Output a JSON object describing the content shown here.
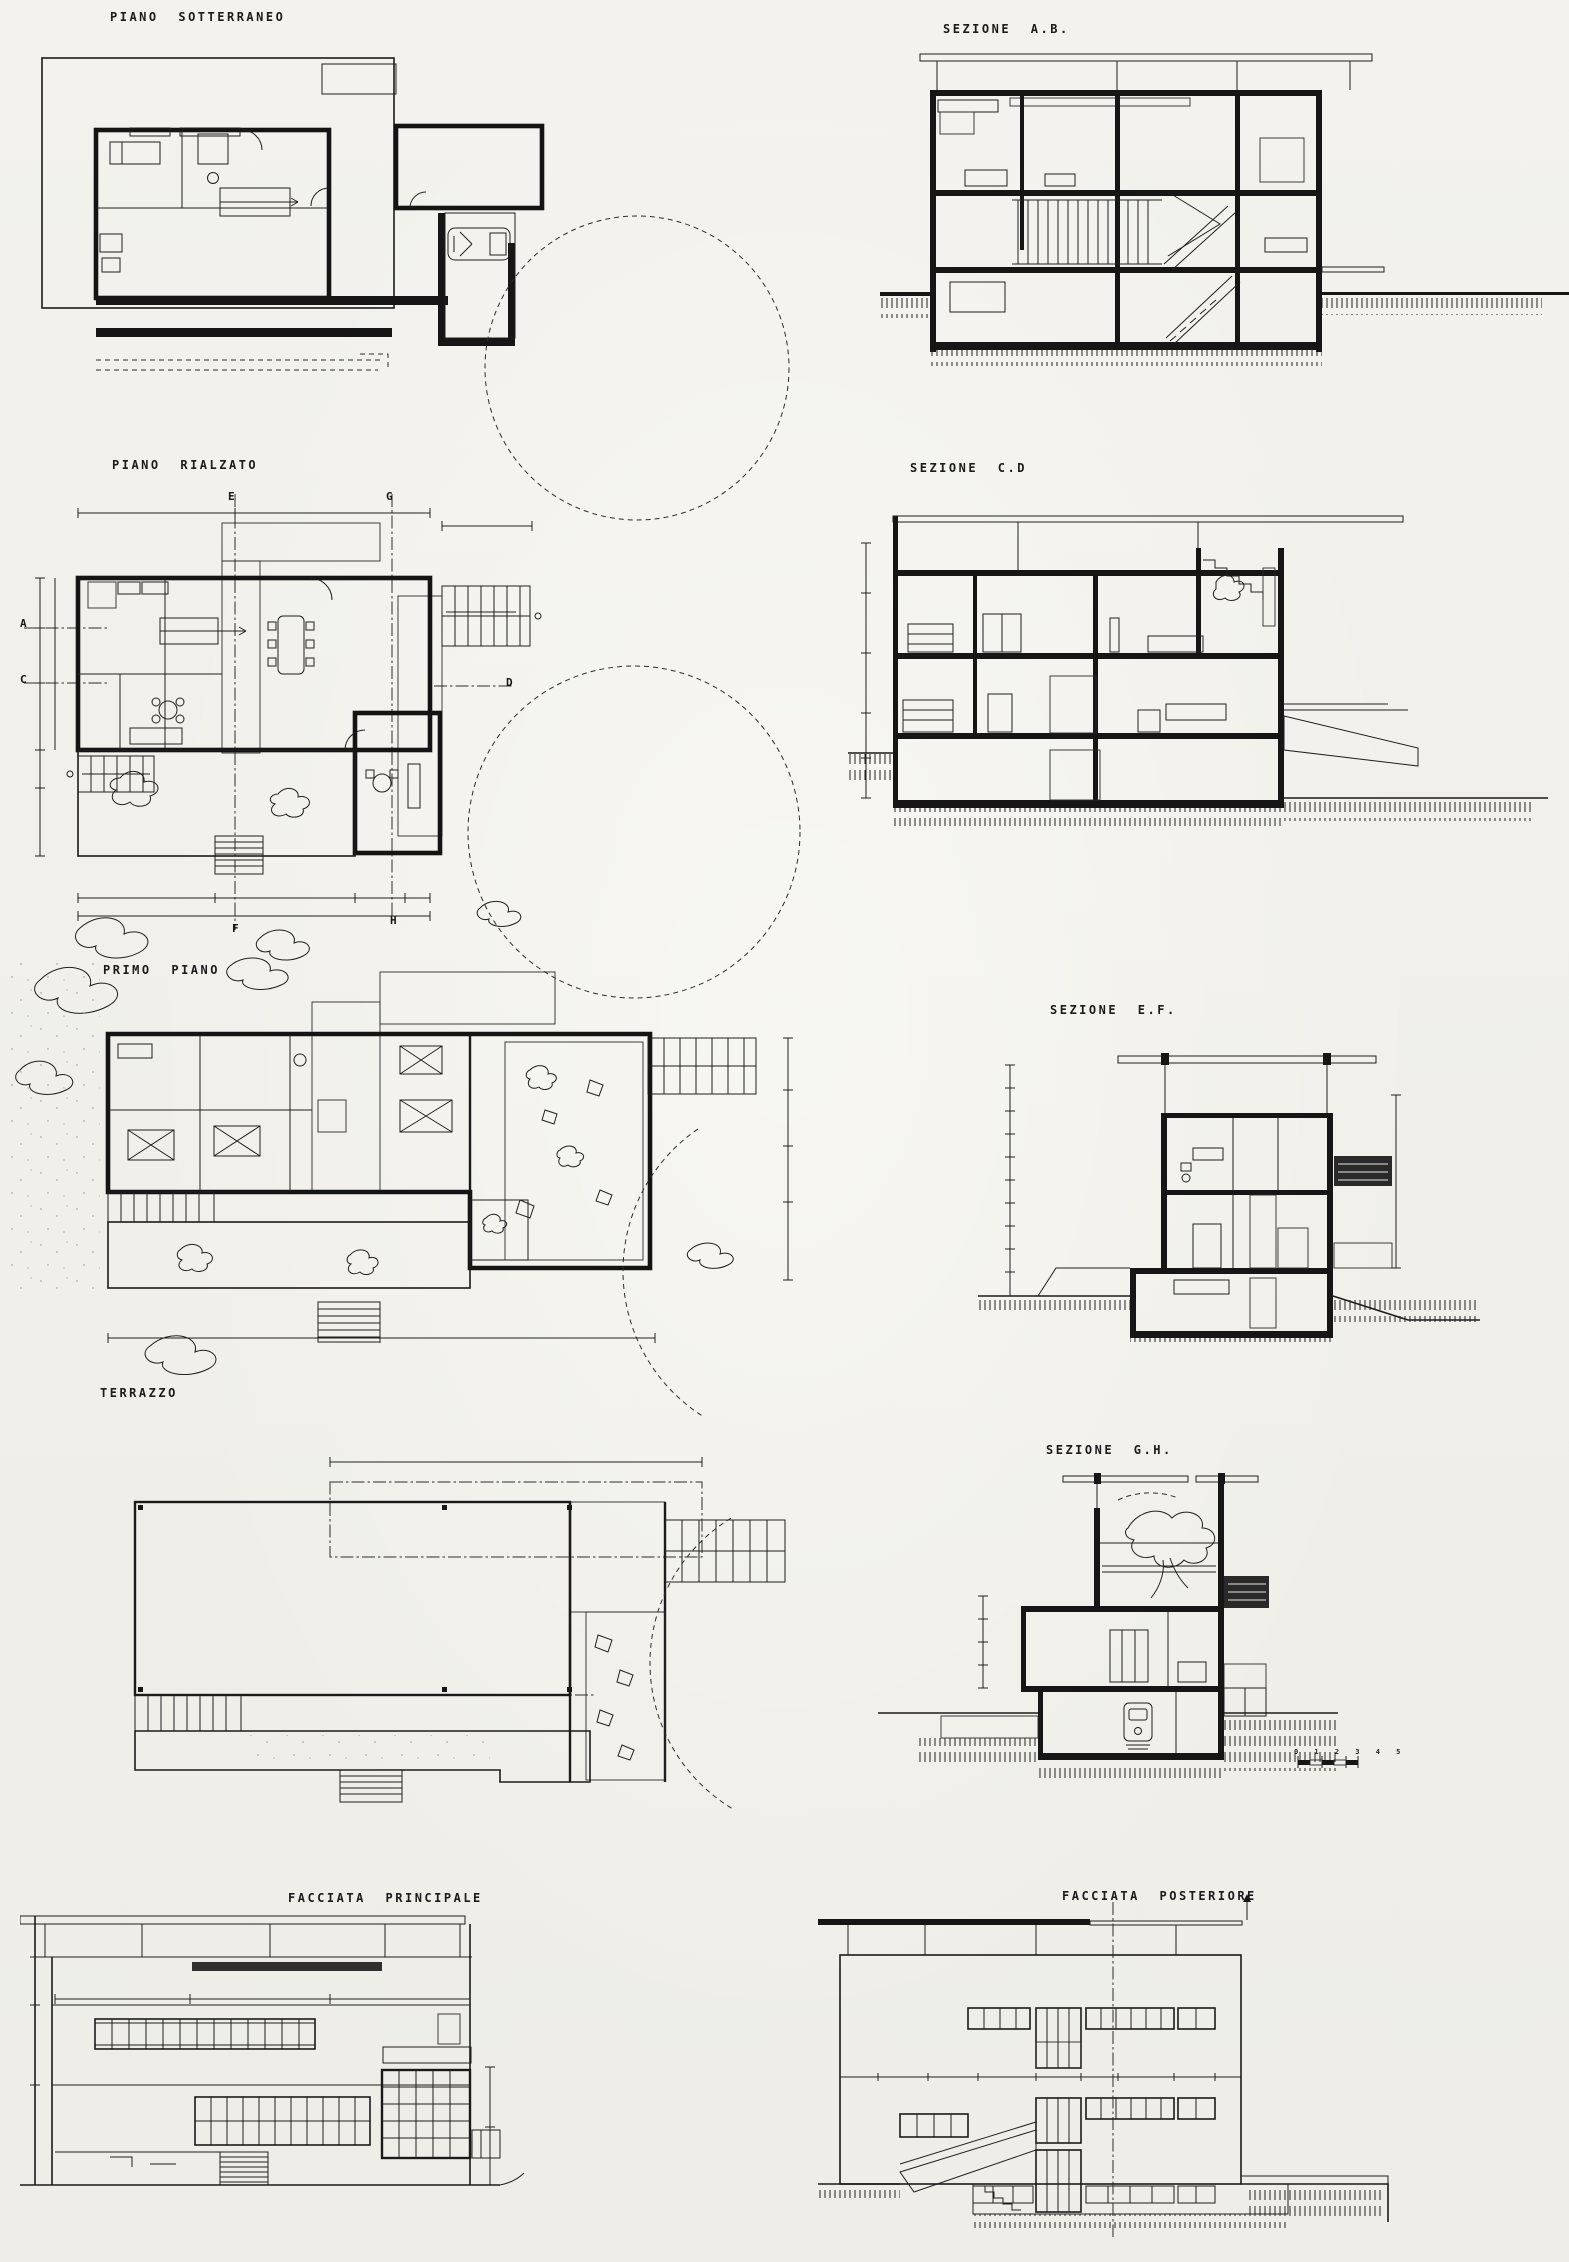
{
  "document": {
    "kind": "scanned architectural drawing sheet",
    "language": "Italian",
    "paper_color": "#f2f1ec",
    "ink_color": "#1b1b1b"
  },
  "panels": {
    "piano_sotterraneo": {
      "label": "PIANO SOTTERRANEO",
      "type": "floor plan"
    },
    "sezione_ab": {
      "label": "SEZIONE A.B.",
      "type": "section"
    },
    "piano_rialzato": {
      "label": "PIANO RIALZATO",
      "type": "floor plan"
    },
    "sezione_cd": {
      "label": "SEZIONE C.D",
      "type": "section"
    },
    "primo_piano": {
      "label": "PRIMO PIANO",
      "type": "floor plan"
    },
    "sezione_ef": {
      "label": "SEZIONE E.F.",
      "type": "section"
    },
    "terrazzo": {
      "label": "TERRAZZO",
      "type": "roof plan"
    },
    "sezione_gh": {
      "label": "SEZIONE G.H.",
      "type": "section"
    },
    "facciata_principale": {
      "label": "FACCIATA PRINCIPALE",
      "type": "elevation"
    },
    "facciata_posteriore": {
      "label": "FACCIATA POSTERIORE",
      "type": "elevation"
    }
  },
  "section_markers": {
    "e": "E",
    "g": "G",
    "a": "A",
    "c": "C",
    "d": "D",
    "f": "F",
    "h": "H"
  },
  "scale_bar": {
    "text": "0 1 2 3 4 5"
  }
}
